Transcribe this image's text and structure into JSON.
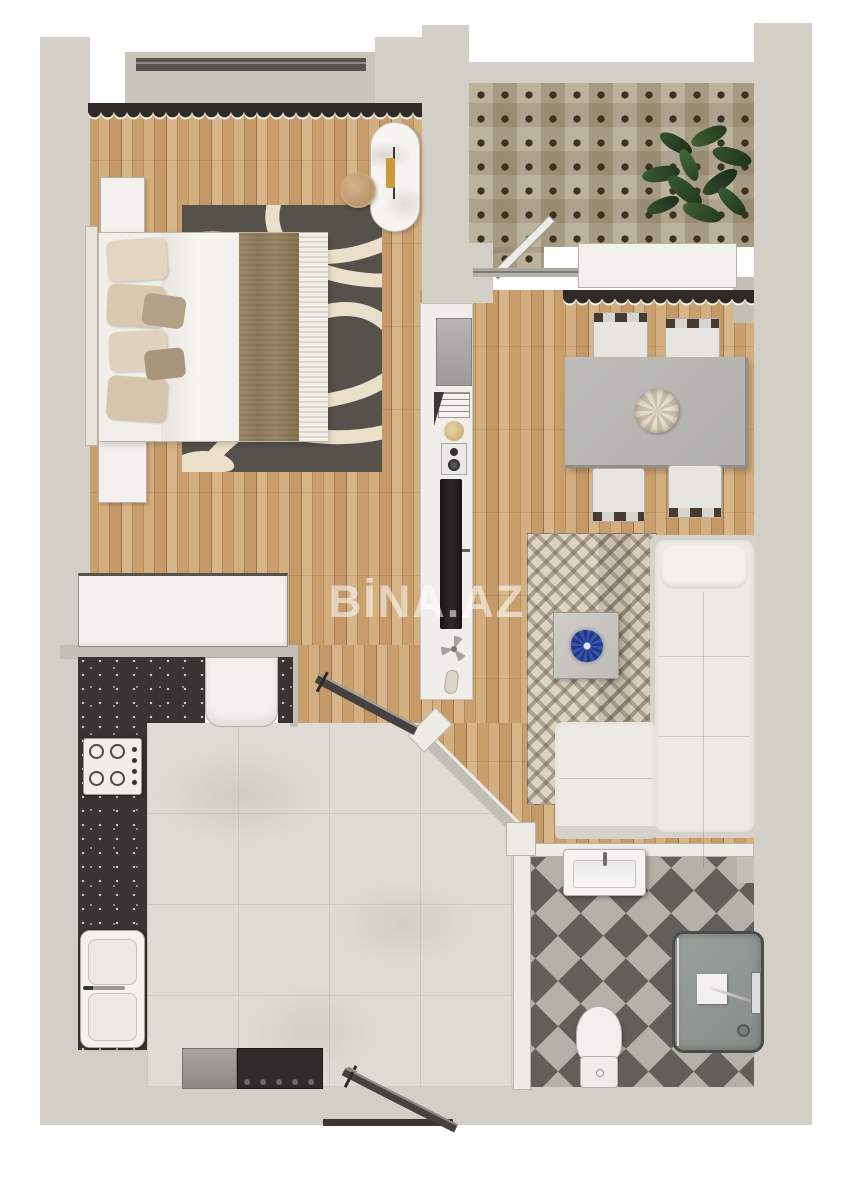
{
  "watermark": {
    "text": "BİNA.AZ"
  },
  "palette": {
    "wall": "#d2cfc7",
    "wallShade": "#c2bfb7",
    "wallFace": "#edebe6",
    "windowSill": "#c8c5bd",
    "windowFrame": "#57544e",
    "marble": "#dedbd4",
    "counter": "#373431",
    "mosaic": "#b0a58a",
    "mosaicDot": "#3c321f",
    "checkerDark": "#615f5a",
    "checkerLight": "#b4b1a9",
    "curtain": "#2e2a25",
    "rugDark": "#56514a",
    "rugCream": "#e9dfca",
    "sofa": "#eceae5",
    "sofaShade": "#d5d2cb",
    "table": "#b6b5b1",
    "chair": "#e7e5e0",
    "chairRail": "#473b2d",
    "white": "#f3f1ed",
    "tv": "#201f1d",
    "plant": "#31492b",
    "gold": "#c79a3a",
    "blue": "#3450ae",
    "steel": "#97958f",
    "dark": "#2e2c29",
    "shower": "#949a94",
    "doorLeaf": "#454240"
  }
}
